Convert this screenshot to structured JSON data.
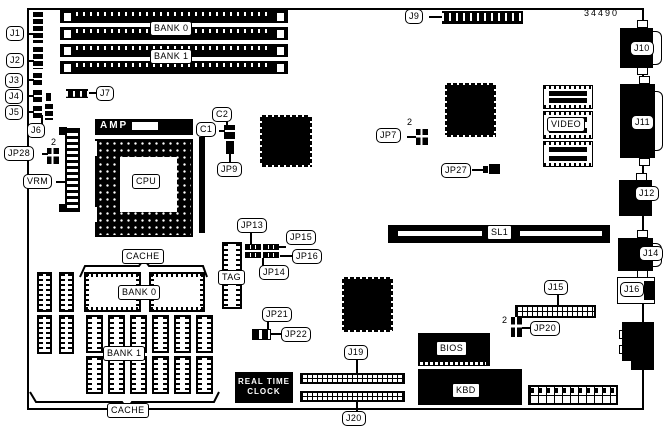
{
  "board": {
    "part_number": "34490",
    "pin1_marker": "2"
  },
  "labels": {
    "j1": "J1",
    "j2": "J2",
    "j3": "J3",
    "j4": "J4",
    "j5": "J5",
    "j6": "J6",
    "j7": "J7",
    "j9": "J9",
    "j10": "J10",
    "j11": "J11",
    "j12": "J12",
    "j14": "J14",
    "j15": "J15",
    "j16": "J16",
    "j19": "J19",
    "j20": "J20",
    "jp7": "JP7",
    "jp9": "JP9",
    "jp13": "JP13",
    "jp14": "JP14",
    "jp15": "JP15",
    "jp16": "JP16",
    "jp20": "JP20",
    "jp21": "JP21",
    "jp22": "JP22",
    "jp27": "JP27",
    "jp28": "JP28",
    "c1": "C1",
    "c2": "C2",
    "cpu": "CPU",
    "amp": "AMP",
    "vrm": "VRM",
    "tag": "TAG",
    "video": "VIDEO",
    "sl1": "SL1",
    "bios": "BIOS",
    "kbd": "KBD",
    "bank0": "BANK 0",
    "bank1": "BANK 1",
    "cache": "CACHE",
    "rtc_line1": "REAL TIME",
    "rtc_line2": "CLOCK"
  }
}
